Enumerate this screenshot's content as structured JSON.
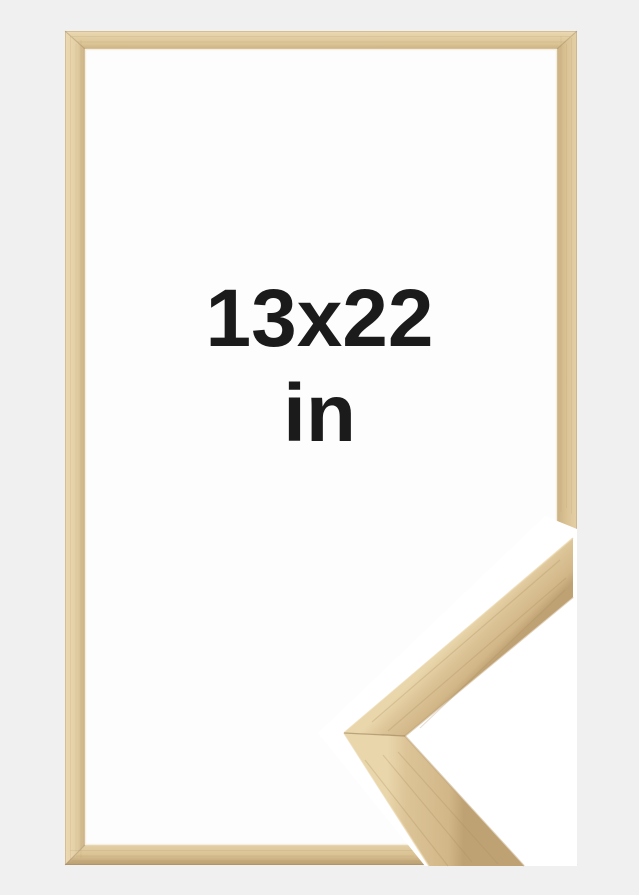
{
  "size_label": {
    "dimensions": "13x22",
    "unit": "in"
  },
  "colors": {
    "background": "#f0f0f1",
    "interior": "#fdfdfd",
    "text": "#1b1b1b",
    "halo": "#ffffff",
    "wood_highlight": "#ecd9b2",
    "wood_light": "#e4d0a7",
    "wood_mid": "#dac293",
    "wood_dark": "#cbb184",
    "wood_edge": "#b89c6f",
    "sample_highlight": "#e9d6ab",
    "sample_light": "#dcc497",
    "sample_mid": "#d2b788",
    "sample_dark": "#bfa274",
    "seam": "#8a6f49",
    "grain": "#a98c5f",
    "lip_highlight": "#f4ecd9"
  }
}
